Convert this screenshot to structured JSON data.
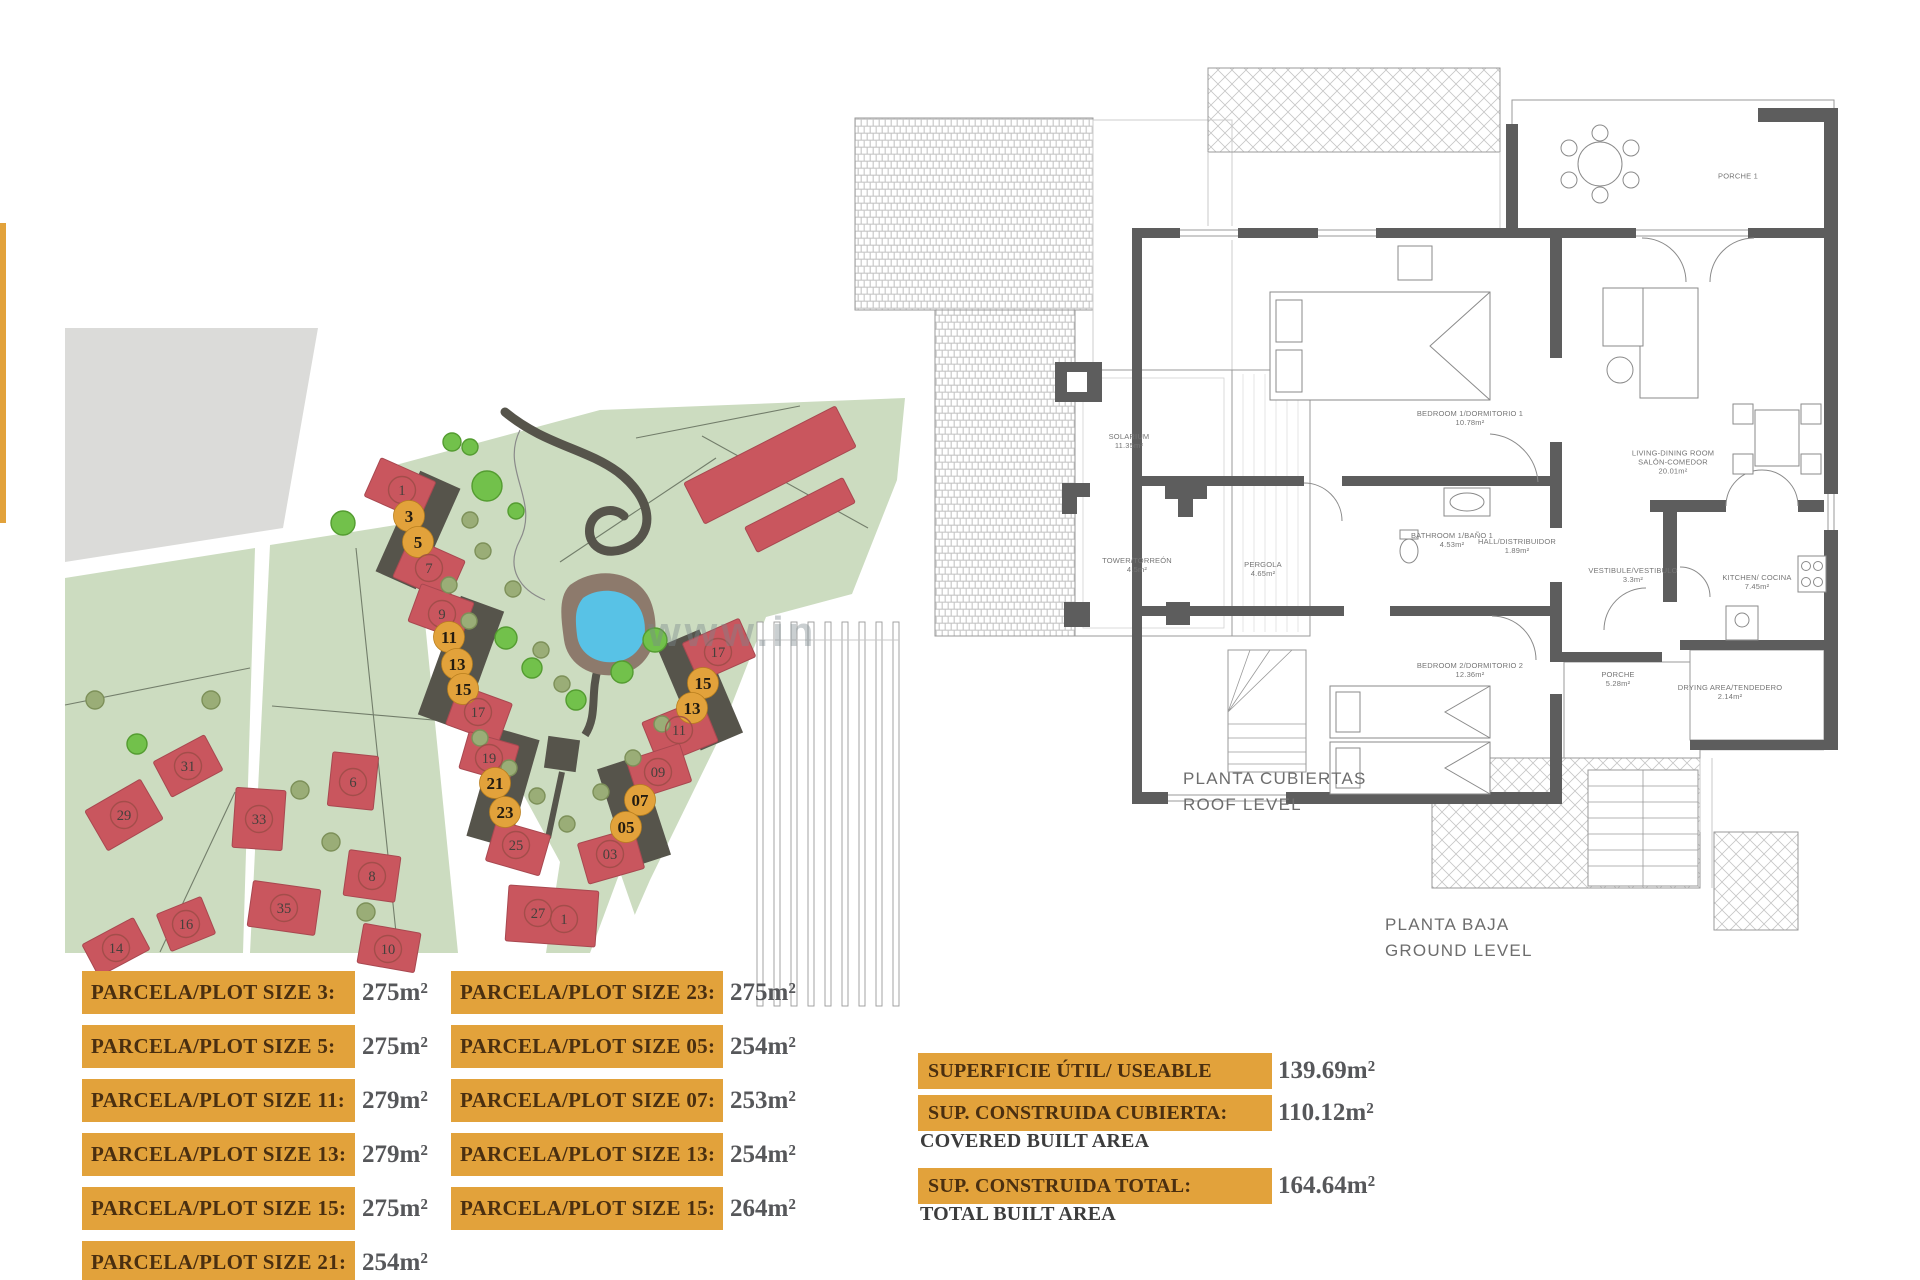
{
  "palette": {
    "accent": "#E2A23B",
    "accent_edge": "#b97f1e",
    "green": "#ccdcc0",
    "gray_block": "#dbdbd9",
    "tree_bright": "#72c14b",
    "tree_bright_edge": "#549c31",
    "tree_olive": "#9aad77",
    "tree_olive_edge": "#7d9059",
    "house": "#c9565e",
    "house_edge": "#a84850",
    "driveway": "#56544b",
    "pool_water": "#58c2e6",
    "pool_deck": "#8d7a6c",
    "marker_ring": "#9c4b47",
    "wall": "#5d5d5d",
    "plan_line": "#9a9a9a"
  },
  "watermark": {
    "text": "www.in"
  },
  "site_map": {
    "driveways": [
      {
        "cx": 418,
        "cy": 530,
        "w": 44,
        "h": 110,
        "rot": 24
      },
      {
        "cx": 461,
        "cy": 663,
        "w": 46,
        "h": 126,
        "rot": 20
      },
      {
        "cx": 503,
        "cy": 788,
        "w": 44,
        "h": 112,
        "rot": 16
      },
      {
        "cx": 700,
        "cy": 690,
        "w": 46,
        "h": 112,
        "rot": -23
      },
      {
        "cx": 634,
        "cy": 812,
        "w": 44,
        "h": 104,
        "rot": -18
      }
    ],
    "houses": [
      {
        "cx": 400,
        "cy": 489,
        "w": 60,
        "h": 42,
        "rot": 24
      },
      {
        "cx": 429,
        "cy": 569,
        "w": 60,
        "h": 44,
        "rot": 24
      },
      {
        "cx": 441,
        "cy": 612,
        "w": 56,
        "h": 40,
        "rot": 20
      },
      {
        "cx": 479,
        "cy": 714,
        "w": 56,
        "h": 42,
        "rot": 20
      },
      {
        "cx": 489,
        "cy": 757,
        "w": 52,
        "h": 38,
        "rot": 16
      },
      {
        "cx": 518,
        "cy": 848,
        "w": 56,
        "h": 42,
        "rot": 16
      },
      {
        "cx": 552,
        "cy": 916,
        "w": 90,
        "h": 56,
        "rot": 4
      },
      {
        "cx": 719,
        "cy": 650,
        "w": 62,
        "h": 42,
        "rot": -24
      },
      {
        "cx": 680,
        "cy": 732,
        "w": 64,
        "h": 46,
        "rot": -22
      },
      {
        "cx": 659,
        "cy": 771,
        "w": 56,
        "h": 40,
        "rot": -18
      },
      {
        "cx": 611,
        "cy": 856,
        "w": 58,
        "h": 42,
        "rot": -16
      },
      {
        "cx": 124,
        "cy": 815,
        "w": 64,
        "h": 46,
        "rot": -30
      },
      {
        "cx": 188,
        "cy": 766,
        "w": 58,
        "h": 40,
        "rot": -28
      },
      {
        "cx": 259,
        "cy": 819,
        "w": 50,
        "h": 60,
        "rot": 4
      },
      {
        "cx": 284,
        "cy": 908,
        "w": 68,
        "h": 46,
        "rot": 8
      },
      {
        "cx": 186,
        "cy": 924,
        "w": 48,
        "h": 40,
        "rot": -22
      },
      {
        "cx": 116,
        "cy": 947,
        "w": 58,
        "h": 36,
        "rot": -28
      },
      {
        "cx": 353,
        "cy": 781,
        "w": 46,
        "h": 54,
        "rot": 6
      },
      {
        "cx": 372,
        "cy": 876,
        "w": 52,
        "h": 46,
        "rot": 8
      },
      {
        "cx": 389,
        "cy": 948,
        "w": 58,
        "h": 40,
        "rot": 10
      },
      {
        "cx": 770,
        "cy": 465,
        "w": 170,
        "h": 46,
        "rot": -27
      },
      {
        "cx": 800,
        "cy": 515,
        "w": 110,
        "h": 28,
        "rot": -27
      }
    ],
    "trees": [
      {
        "x": 343,
        "y": 523,
        "r": 12,
        "k": "b"
      },
      {
        "x": 452,
        "y": 442,
        "r": 9,
        "k": "b"
      },
      {
        "x": 487,
        "y": 486,
        "r": 15,
        "k": "b"
      },
      {
        "x": 516,
        "y": 511,
        "r": 8,
        "k": "b"
      },
      {
        "x": 655,
        "y": 640,
        "r": 12,
        "k": "b"
      },
      {
        "x": 622,
        "y": 672,
        "r": 11,
        "k": "b"
      },
      {
        "x": 506,
        "y": 638,
        "r": 11,
        "k": "b"
      },
      {
        "x": 532,
        "y": 668,
        "r": 10,
        "k": "b"
      },
      {
        "x": 576,
        "y": 700,
        "r": 10,
        "k": "b"
      },
      {
        "x": 470,
        "y": 447,
        "r": 8,
        "k": "b"
      },
      {
        "x": 470,
        "y": 520,
        "r": 8,
        "k": "o"
      },
      {
        "x": 483,
        "y": 551,
        "r": 8,
        "k": "o"
      },
      {
        "x": 449,
        "y": 585,
        "r": 8,
        "k": "o"
      },
      {
        "x": 513,
        "y": 589,
        "r": 8,
        "k": "o"
      },
      {
        "x": 469,
        "y": 621,
        "r": 8,
        "k": "o"
      },
      {
        "x": 541,
        "y": 650,
        "r": 8,
        "k": "o"
      },
      {
        "x": 562,
        "y": 684,
        "r": 8,
        "k": "o"
      },
      {
        "x": 480,
        "y": 738,
        "r": 8,
        "k": "o"
      },
      {
        "x": 509,
        "y": 768,
        "r": 8,
        "k": "o"
      },
      {
        "x": 537,
        "y": 796,
        "r": 8,
        "k": "o"
      },
      {
        "x": 567,
        "y": 824,
        "r": 8,
        "k": "o"
      },
      {
        "x": 601,
        "y": 792,
        "r": 8,
        "k": "o"
      },
      {
        "x": 633,
        "y": 758,
        "r": 8,
        "k": "o"
      },
      {
        "x": 662,
        "y": 724,
        "r": 8,
        "k": "o"
      },
      {
        "x": 300,
        "y": 790,
        "r": 9,
        "k": "o"
      },
      {
        "x": 331,
        "y": 842,
        "r": 9,
        "k": "o"
      },
      {
        "x": 366,
        "y": 912,
        "r": 9,
        "k": "o"
      },
      {
        "x": 137,
        "y": 744,
        "r": 10,
        "k": "b"
      },
      {
        "x": 211,
        "y": 700,
        "r": 9,
        "k": "o"
      },
      {
        "x": 95,
        "y": 700,
        "r": 9,
        "k": "o"
      }
    ],
    "markers": [
      {
        "label": "1",
        "x": 402,
        "y": 490,
        "type": "ol"
      },
      {
        "label": "3",
        "x": 409,
        "y": 516,
        "type": "hl"
      },
      {
        "label": "5",
        "x": 418,
        "y": 542,
        "type": "hl"
      },
      {
        "label": "7",
        "x": 429,
        "y": 568,
        "type": "ol"
      },
      {
        "label": "9",
        "x": 442,
        "y": 614,
        "type": "ol"
      },
      {
        "label": "11",
        "x": 449,
        "y": 637,
        "type": "hl"
      },
      {
        "label": "13",
        "x": 457,
        "y": 664,
        "type": "hl"
      },
      {
        "label": "15",
        "x": 463,
        "y": 689,
        "type": "hl"
      },
      {
        "label": "17",
        "x": 478,
        "y": 712,
        "type": "ol"
      },
      {
        "label": "19",
        "x": 489,
        "y": 758,
        "type": "ol"
      },
      {
        "label": "21",
        "x": 495,
        "y": 783,
        "type": "hl"
      },
      {
        "label": "23",
        "x": 505,
        "y": 812,
        "type": "hl"
      },
      {
        "label": "25",
        "x": 516,
        "y": 845,
        "type": "ol"
      },
      {
        "label": "27",
        "x": 538,
        "y": 913,
        "type": "ol"
      },
      {
        "label": "1",
        "x": 564,
        "y": 919,
        "type": "ol"
      },
      {
        "label": "17",
        "x": 718,
        "y": 652,
        "type": "ol"
      },
      {
        "label": "15",
        "x": 703,
        "y": 683,
        "type": "hl"
      },
      {
        "label": "13",
        "x": 692,
        "y": 708,
        "type": "hl"
      },
      {
        "label": "11",
        "x": 679,
        "y": 730,
        "type": "ol"
      },
      {
        "label": "09",
        "x": 658,
        "y": 772,
        "type": "ol"
      },
      {
        "label": "07",
        "x": 640,
        "y": 800,
        "type": "hl"
      },
      {
        "label": "05",
        "x": 626,
        "y": 827,
        "type": "hl"
      },
      {
        "label": "03",
        "x": 610,
        "y": 854,
        "type": "ol"
      },
      {
        "label": "29",
        "x": 124,
        "y": 815,
        "type": "ol"
      },
      {
        "label": "31",
        "x": 188,
        "y": 766,
        "type": "ol"
      },
      {
        "label": "33",
        "x": 259,
        "y": 819,
        "type": "ol"
      },
      {
        "label": "35",
        "x": 284,
        "y": 908,
        "type": "ol"
      },
      {
        "label": "16",
        "x": 186,
        "y": 924,
        "type": "ol"
      },
      {
        "label": "14",
        "x": 116,
        "y": 948,
        "type": "ol"
      },
      {
        "label": "6",
        "x": 353,
        "y": 782,
        "type": "ol"
      },
      {
        "label": "8",
        "x": 372,
        "y": 876,
        "type": "ol"
      },
      {
        "label": "10",
        "x": 388,
        "y": 949,
        "type": "ol"
      }
    ]
  },
  "roof_plan": {
    "caption_line1": "PLANTA CUBIERTAS",
    "caption_line2": "ROOF LEVEL",
    "rooms": [
      {
        "label": "SOLARIUM",
        "area": "11.35m²",
        "x": 1129,
        "y": 441
      },
      {
        "label": "TOWER/TORREÓN",
        "area": "4.5m²",
        "x": 1137,
        "y": 565
      },
      {
        "label": "PERGOLA",
        "area": "4.65m²",
        "x": 1263,
        "y": 569
      }
    ]
  },
  "ground_plan": {
    "caption_line1": "PLANTA BAJA",
    "caption_line2": "GROUND LEVEL",
    "rooms": [
      {
        "label": "BEDROOM 1/DORMITORIO 1",
        "area": "10.78m²",
        "x": 1470,
        "y": 418
      },
      {
        "label": "BATHROOM 1/BAÑO 1",
        "area": "4.53m²",
        "x": 1452,
        "y": 540
      },
      {
        "label": "HALL/DISTRIBUIDOR",
        "area": "1.89m²",
        "x": 1517,
        "y": 546
      },
      {
        "label": "LIVING-DINING ROOM",
        "line2": "SALÓN-COMEDOR",
        "area": "20.01m²",
        "x": 1673,
        "y": 462
      },
      {
        "label": "KITCHEN/ COCINA",
        "area": "7.45m²",
        "x": 1757,
        "y": 582
      },
      {
        "label": "VESTIBULE/VESTIBULO",
        "area": "3.3m²",
        "x": 1633,
        "y": 575
      },
      {
        "label": "BEDROOM 2/DORMITORIO 2",
        "area": "12.36m²",
        "x": 1470,
        "y": 670
      },
      {
        "label": "PORCHE",
        "area": "5.28m²",
        "x": 1618,
        "y": 679
      },
      {
        "label": "DRYING AREA/TENDEDERO",
        "area": "2.14m²",
        "x": 1730,
        "y": 692
      },
      {
        "label": "PORCHE 1",
        "area": "",
        "x": 1738,
        "y": 176
      }
    ]
  },
  "plot_sizes": {
    "left": [
      {
        "label": "PARCELA/PLOT SIZE 3:",
        "value": "275m²"
      },
      {
        "label": "PARCELA/PLOT SIZE 5:",
        "value": "275m²"
      },
      {
        "label": "PARCELA/PLOT SIZE 11:",
        "value": "279m²"
      },
      {
        "label": "PARCELA/PLOT SIZE 13:",
        "value": "279m²"
      },
      {
        "label": "PARCELA/PLOT SIZE 15:",
        "value": "275m²"
      },
      {
        "label": "PARCELA/PLOT SIZE 21:",
        "value": "254m²"
      }
    ],
    "right": [
      {
        "label": "PARCELA/PLOT SIZE 23:",
        "value": "275m²"
      },
      {
        "label": "PARCELA/PLOT SIZE 05:",
        "value": "254m²"
      },
      {
        "label": "PARCELA/PLOT SIZE 07:",
        "value": "253m²"
      },
      {
        "label": "PARCELA/PLOT SIZE 13:",
        "value": "254m²"
      },
      {
        "label": "PARCELA/PLOT SIZE 15:",
        "value": "264m²"
      }
    ]
  },
  "summary": [
    {
      "label": "SUPERFICIE ÚTIL/ USEABLE AREA:",
      "sub": "",
      "value": "139.69m²"
    },
    {
      "label": "SUP. CONSTRUIDA CUBIERTA:",
      "sub": "COVERED BUILT AREA",
      "value": "110.12m²"
    },
    {
      "label": "SUP. CONSTRUIDA TOTAL:",
      "sub": "TOTAL BUILT AREA",
      "value": "164.64m²"
    }
  ]
}
